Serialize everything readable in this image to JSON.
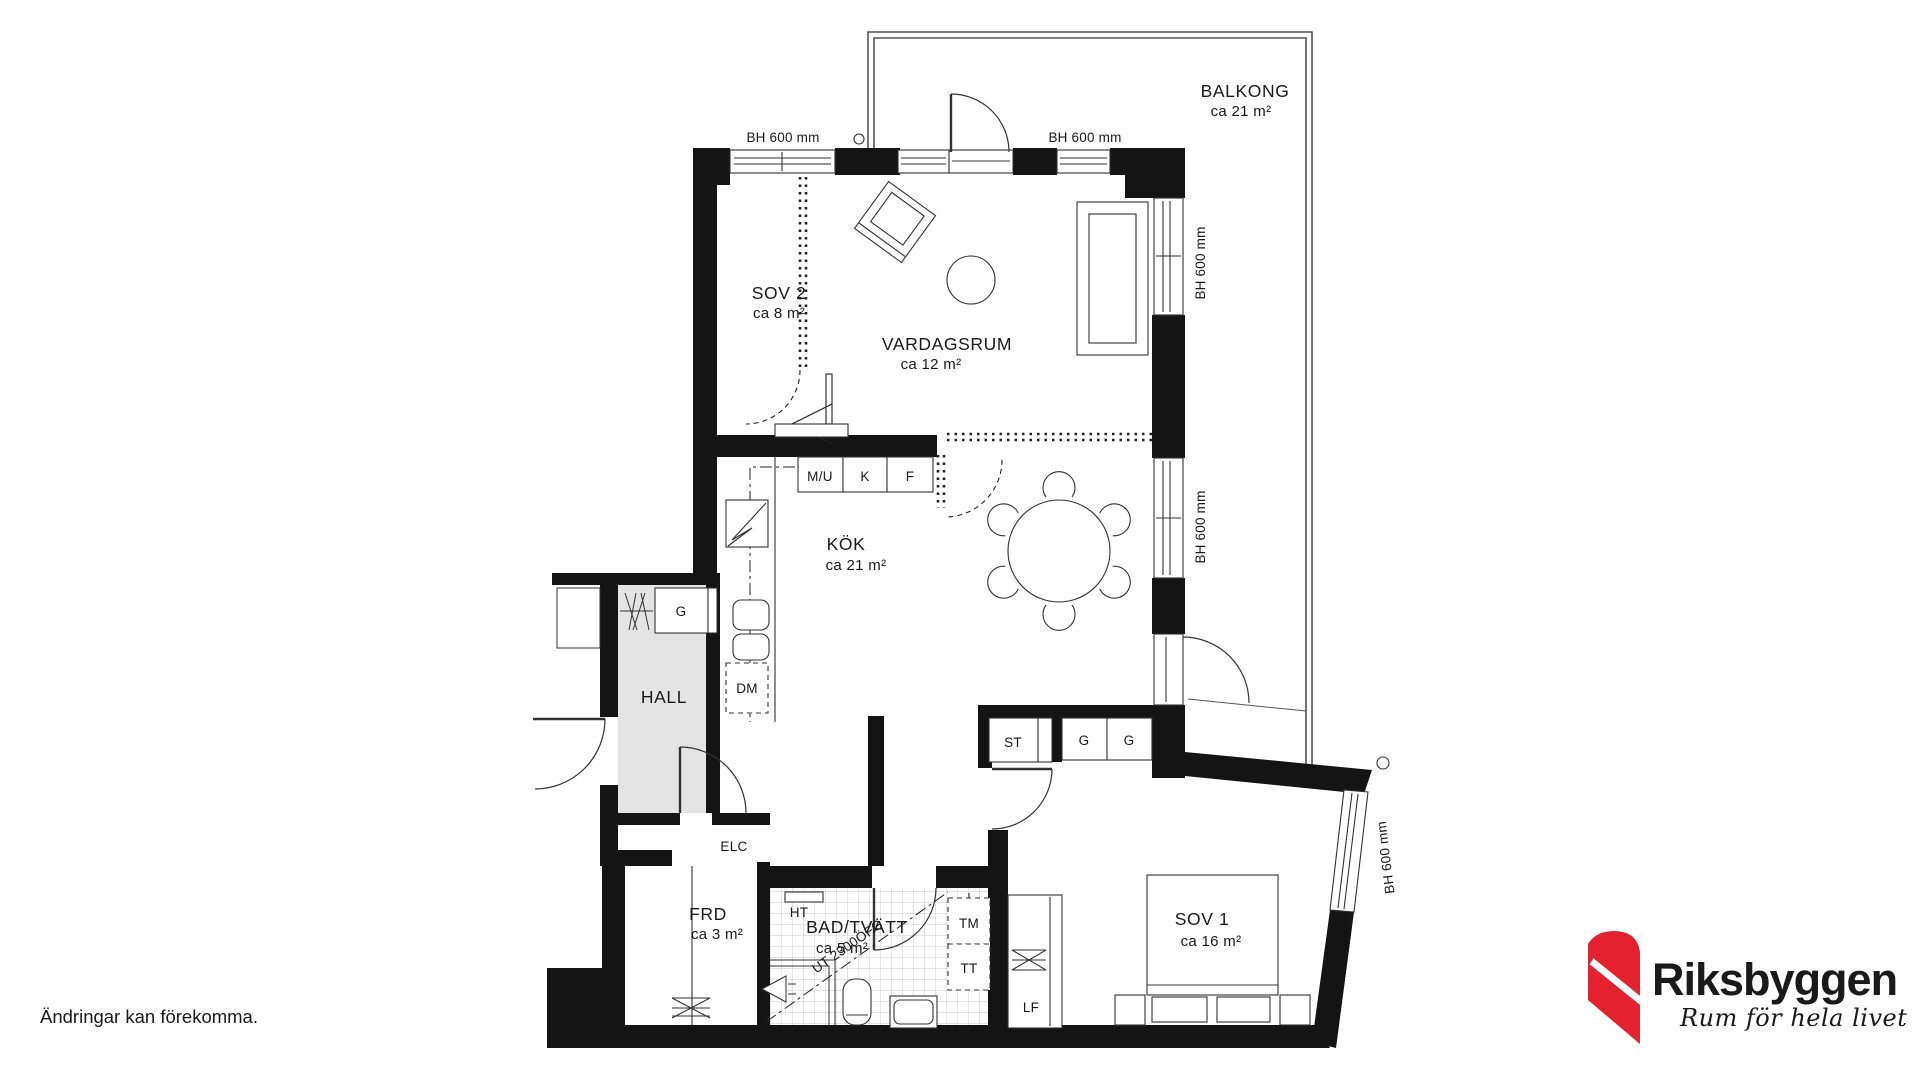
{
  "footer": {
    "disclaimer": "Ändringar kan förekomma."
  },
  "logo": {
    "brand": "Riksbyggen",
    "tagline": "Rum för hela livet",
    "brand_color": "#8C8C8C",
    "mark_color": "#E4212E"
  },
  "plan": {
    "colors": {
      "wall": "#141414",
      "line": "#333333",
      "hall_floor": "#e4e4e4",
      "tile_line": "#c9c9c9"
    },
    "rooms": [
      {
        "id": "balkong",
        "name": "BALKONG",
        "area": "ca 21 m²"
      },
      {
        "id": "sov2",
        "name": "SOV 2",
        "area": "ca 8 m²"
      },
      {
        "id": "vardagsrum",
        "name": "VARDAGSRUM",
        "area": "ca 12 m²"
      },
      {
        "id": "kok",
        "name": "KÖK",
        "area": "ca 21 m²"
      },
      {
        "id": "hall",
        "name": "HALL",
        "area": ""
      },
      {
        "id": "frd",
        "name": "FRD",
        "area": "ca 3 m²"
      },
      {
        "id": "bad",
        "name": "BAD/TVÄTT",
        "area": "ca 5 m²"
      },
      {
        "id": "sov1",
        "name": "SOV 1",
        "area": "ca 16 m²"
      }
    ],
    "labels": {
      "bh": "BH 600 mm",
      "vent": "UT 2300ÖFG",
      "mu": "M/U",
      "k": "K",
      "f": "F",
      "g": "G",
      "dm": "DM",
      "st": "ST",
      "elc": "ELC",
      "ht": "HT",
      "tm": "TM",
      "tt": "TT",
      "lf": "LF"
    }
  }
}
